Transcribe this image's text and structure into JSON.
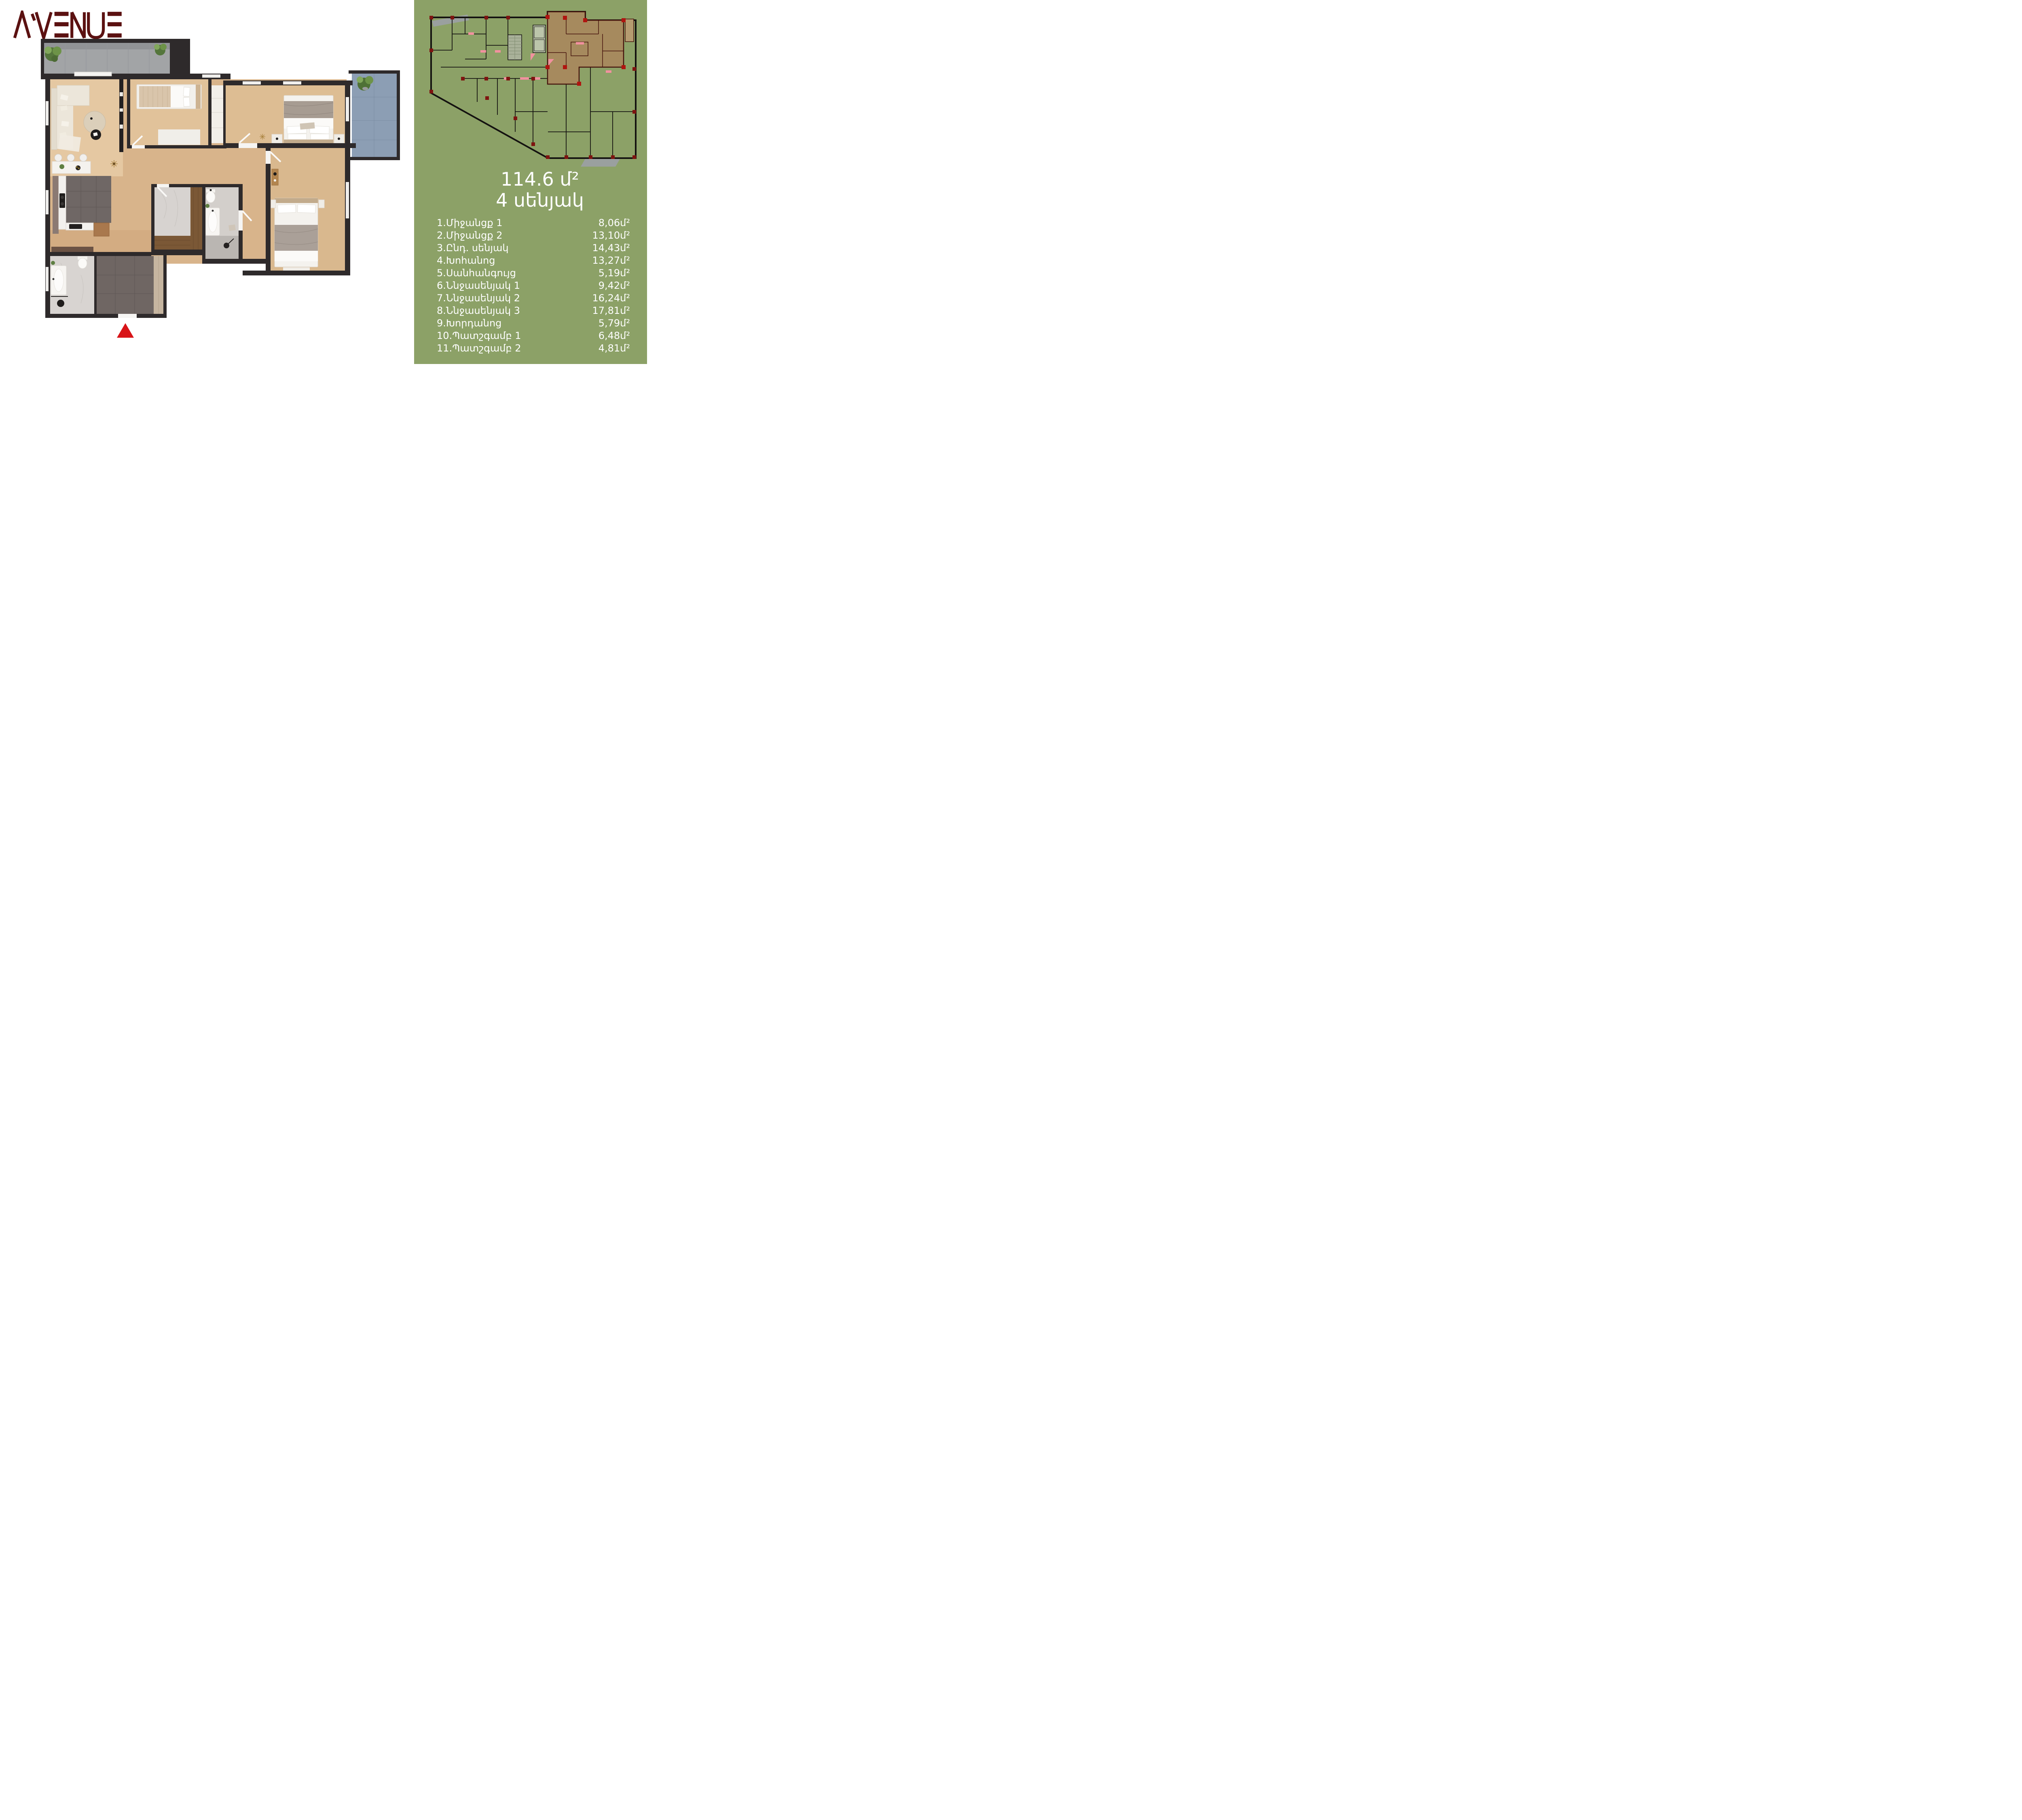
{
  "brand": {
    "name": "AVENUE",
    "sub": "Davtashen"
  },
  "panel": {
    "bg_color": "#8CA167",
    "area_title": "114.6 մ²",
    "rooms_title": "4 սենյակ"
  },
  "rooms": [
    {
      "label": "1.Միջանցք 1",
      "area": "8,06մ²"
    },
    {
      "label": "2.Միջանցք 2",
      "area": "13,10մ²"
    },
    {
      "label": "3.Ընդ. սենյակ",
      "area": "14,43մ²"
    },
    {
      "label": "4.Խոհանոց",
      "area": "13,27մ²"
    },
    {
      "label": "5.Սանհանգույց",
      "area": "5,19մ²"
    },
    {
      "label": "6.Ննջասենյակ 1",
      "area": "9,42մ²"
    },
    {
      "label": "7.Ննջասենյակ 2",
      "area": "16,24մ²"
    },
    {
      "label": "8.Ննջասենյակ 3",
      "area": "17,81մ²"
    },
    {
      "label": "9.Խորդանոց",
      "area": "5,79մ²"
    },
    {
      "label": "10.Պատշգամբ 1",
      "area": "6,48մ²"
    },
    {
      "label": "11.Պատշգամբ 2",
      "area": "4,81մ²"
    }
  ],
  "colors": {
    "brand_maroon": "#5B1111",
    "brand_sub_gray": "#4B4B4D",
    "wall_dark": "#2E2A2B",
    "wood_floor": "#D8B48B",
    "kitchen_tile": "#6F6765",
    "balcony_tile_gray": "#A2A4A6",
    "balcony_tile_blue": "#8C9EB4",
    "highlight_unit_brown": "#A8895E",
    "minimap_wall": "#141210",
    "column_red": "#B01510",
    "door_pink": "#F2919F",
    "entrance_marker_red": "#D81418",
    "text_white": "#FFFFFF"
  },
  "icons": {
    "entrance_marker": "triangle-up",
    "plant": "potted-plant",
    "stairs": "stair-treads",
    "elevator": "elevator-shaft"
  }
}
